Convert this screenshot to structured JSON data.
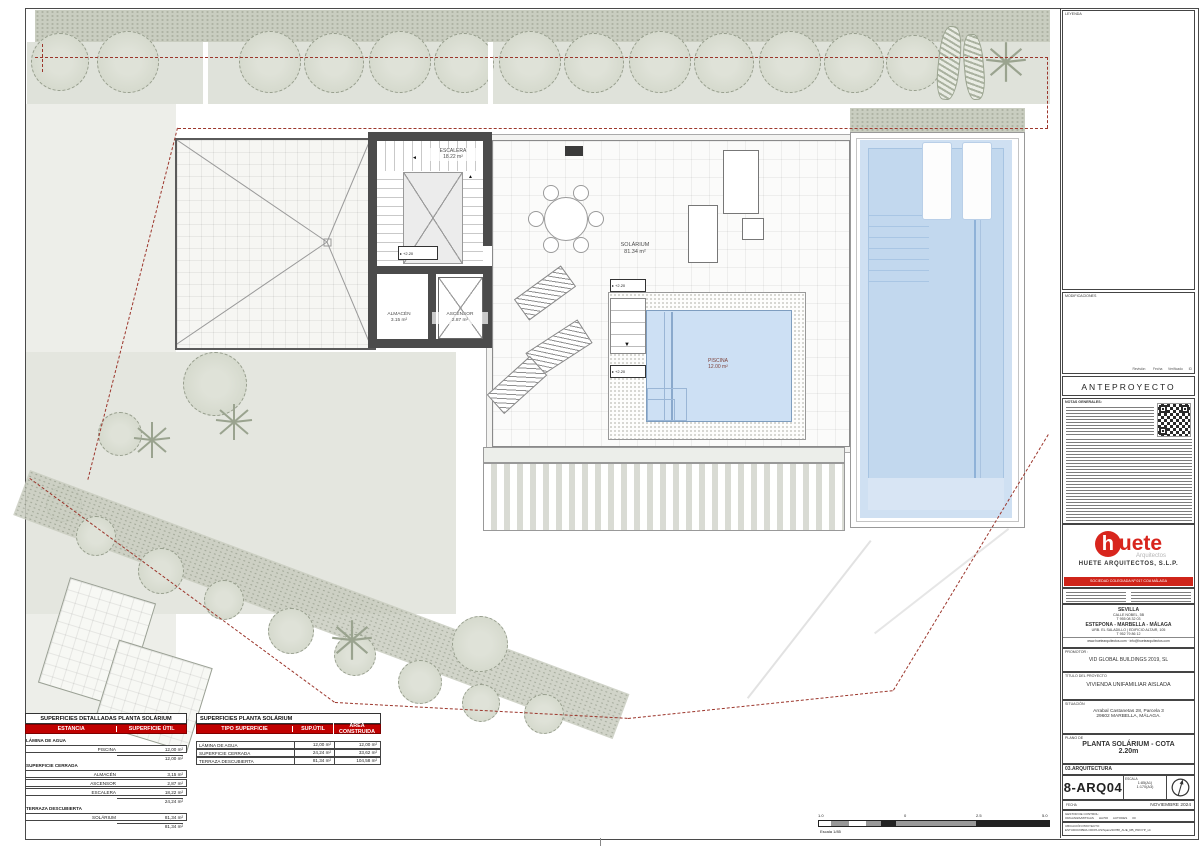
{
  "colors": {
    "accent_red": "#cc0000",
    "logo_red": "#d8251d",
    "boundary_red": "#9c362c",
    "pool_blue": "#cfe0f2"
  },
  "plan": {
    "rooms": {
      "escalera": {
        "name": "ESCALERA",
        "area": "18.22 m²"
      },
      "almacen": {
        "name": "ALMACÉN",
        "area": "3.15 m²"
      },
      "ascensor": {
        "name": "ASCENSOR",
        "area": "2.87 m²"
      },
      "solarium": {
        "name": "SOLÁRIUM",
        "area": "81.34 m²"
      },
      "piscina": {
        "name": "PISCINA",
        "area": "12.00 m²"
      }
    },
    "level_marker": "+2.20"
  },
  "tables": {
    "detailed": {
      "title": "SUPERFICIES DETALLADAS PLANTA SOLÁRIUM",
      "col1": "ESTANCIA",
      "col2": "SUPERFICIE ÚTIL",
      "sections": [
        {
          "label": "LÁMINA DE AGUA",
          "rows": [
            {
              "name": "PISCINA",
              "value": "12,00 m²"
            }
          ],
          "subtotal": "12,00 m²"
        },
        {
          "label": "SUPERFICIE CERRADA",
          "rows": [
            {
              "name": "ALMACÉN",
              "value": "3,15 m²"
            },
            {
              "name": "ASCENSOR",
              "value": "2,87 m²"
            },
            {
              "name": "ESCALERA",
              "value": "18,22 m²"
            }
          ],
          "subtotal": "24,24 m²"
        },
        {
          "label": "TERRAZA DESCUBIERTA",
          "rows": [
            {
              "name": "SOLÁRIUM",
              "value": "81,34 m²"
            }
          ],
          "subtotal": "81,34 m²"
        }
      ]
    },
    "summary": {
      "title": "SUPERFICIES PLANTA SOLÁRIUM",
      "headers": [
        "TIPO SUPERFICIE",
        "SUP.ÚTIL",
        "ÁREA CONSTRUIDA"
      ],
      "rows": [
        {
          "tipo": "LÁMINA DE AGUA",
          "util": "12,00 m²",
          "construida": "12,00 m²"
        },
        {
          "tipo": "SUPERFICIE CERRADA",
          "util": "24,24 m²",
          "construida": "33,62 m²"
        },
        {
          "tipo": "TERRAZA DESCUBIERTA",
          "util": "81,34 m²",
          "construida": "104,58 m²"
        }
      ]
    }
  },
  "scalebar": {
    "labels": [
      "1.0",
      "0",
      "2.5",
      "5.0"
    ],
    "caption": "Escala 1/85"
  },
  "titleblock": {
    "legend_label": "LEYENDA",
    "modifications_label": "MODIFICACIONES",
    "revision_headers": "Revisión        Fecha      Verificado      ID",
    "status": "ANTEPROYECTO",
    "notes_label": "NOTAS GENERALES:",
    "logo": {
      "h": "h",
      "uete": "uete",
      "sub": "Arquitectos",
      "firm": "HUETE ARQUITECTOS, S.L.P.",
      "band": "SOCIEDAD COLEGIADA Nº 017 COA MÁLAGA"
    },
    "offices": {
      "city1": "SEVILLA",
      "addr1": "CALLE NOBEL, 5B",
      "tel1": "T 955 08 32 03",
      "city2": "ESTEPONA - MARBELLA - MÁLAGA",
      "addr2": "URB. EL SALADILLO | EDIFICIO ALTAIR, 105",
      "tel2": "T 952 79 86 12",
      "web": "www.huetearquitectos.com  ·  info@huetearquitectos.com"
    },
    "promotor_label": "PROMOTOR :",
    "promotor": "VID GLOBAL BUILDINGS 2019, SL",
    "project_label": "TÍTULO DEL PROYECTO",
    "project": "VIVIENDA UNIFAMILIAR AISLADA",
    "location_label": "SITUACIÓN",
    "location1": "Arrabal Castanetas 28, Parcela 3",
    "location2": "29602 MARBELLA, MÁLAGA.",
    "sheet_label": "PLANO DE",
    "sheet1": "PLANTA SOLÁRIUM - COTA",
    "sheet2": "2.20m",
    "discipline": "03.ARQUITECTURA",
    "code": "8-ARQ04",
    "scale_label": "ESCALA",
    "scale1": "1:85(A1)",
    "scale2": "1:170(A3)",
    "date_label": "FECHA",
    "date": "NOVIEMBRE 2024",
    "control_label": "GESTOR DE CONTROL:",
    "control": "ORGANIZA/MITIGAS      HA700      AUTODES      00",
    "path_label": "UBICACIÓN PROYECTO",
    "path": "ESTUDIO/OBRA OFFPLUS/Spain/20788_AUE_RB_PROYP_v4"
  }
}
